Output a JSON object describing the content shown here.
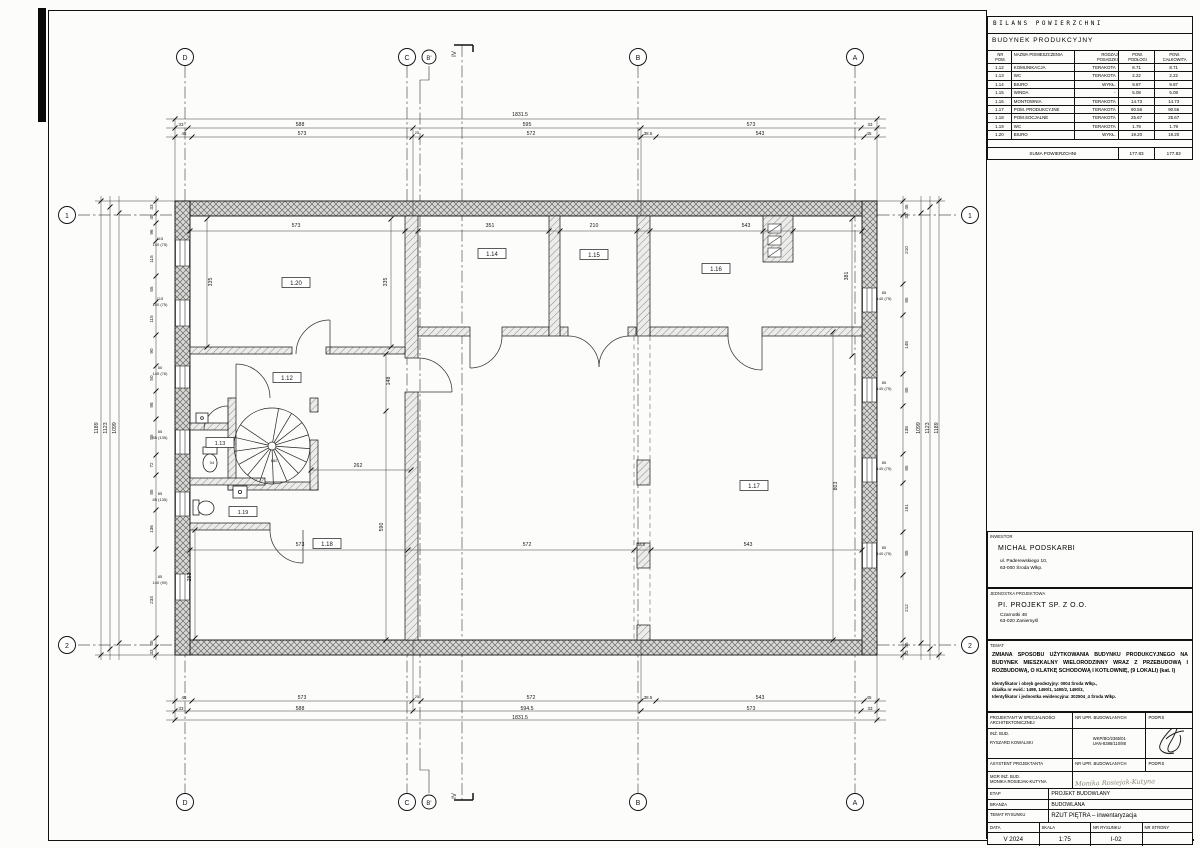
{
  "table": {
    "title": "BILANS POWIERZCHNI",
    "subtitle": "BUDYNEK PRODUKCYJNY",
    "headers": [
      "NR\nPOM.",
      "NAZWA POMIESZCZENIA",
      "RODZAJ\nPOSADZKI",
      "POW.\nPODŁOGI",
      "POW.\nCAŁKOWITA"
    ],
    "rows": [
      [
        "1.12",
        "KOMUNIKACJA",
        "TERAKOTA",
        "8.71",
        "8.71"
      ],
      [
        "1.13",
        "WC",
        "TERAKOTA",
        "2.22",
        "2.22"
      ],
      [
        "1.14",
        "BIURO",
        "WYKŁ. DYWANOWA",
        "9.87",
        "9.87"
      ],
      [
        "1.15",
        "WINDA",
        "-",
        "5.08",
        "5.08"
      ],
      [
        "1.16",
        "MONTOWNIA",
        "TERAKOTA",
        "14.73",
        "14.73"
      ],
      [
        "1.17",
        "POM. PRODUKCYJNE",
        "TERAKOTA",
        "90.56",
        "90.56"
      ],
      [
        "1.18",
        "POM.SOCJALNE",
        "TERAKOTA",
        "25.67",
        "25.67"
      ],
      [
        "1.19",
        "WC",
        "TERAKOTA",
        "1.79",
        "1.79"
      ],
      [
        "1.20",
        "BIURO",
        "WYKŁ. DYWANOWA",
        "19.20",
        "19.20"
      ]
    ],
    "sum_label": "SUMA POWIERZCHNI",
    "sum_floor": "177.83",
    "sum_total": "177.83"
  },
  "investor": {
    "label": "INWESTOR",
    "name": "MICHAŁ PODSKARBI",
    "addr1": "ul. Paderewskiego 10,",
    "addr2": "63-000 Środa Wlkp."
  },
  "unit": {
    "label": "JEDNOSTKA PROJEKTOWA",
    "name": "PI. PROJEKT SP. Z O.O.",
    "addr1": "Czarnotki 48",
    "addr2": "63-020 Zaniemyśl"
  },
  "temat": {
    "label": "TEMAT",
    "line1": "ZMIANA SPOSOBU UŻYTKOWANIA BUDYNKU PRODUKCYJNEGO NA BUDYNEK MIESZKALNY WIELORODZINNY WRAZ Z PRZEBUDOWĄ I ROZBUDOWĄ, O KLATKĘ SCHODOWĄ I KOTŁOWNIĘ, (9 LOKALI) (kat. I)",
    "geo1": "Identyfikator i obręb geodezyjny: 0004 Środa Wlkp.,",
    "geo2": "działka nr ewid.: 1498, 1490/1, 1490/2, 1490/3,",
    "geo3": "Identyfikator i jednostka ewidencyjna: 302504_4 Środa Wlkp."
  },
  "sig": {
    "r1a": "PROJEKTANT W SPECJALNOŚCI\nARCHITEKTONICZNEJ",
    "r1b": "NR UPR. BUDOWLANYCH",
    "r1c": "PODPIS",
    "r2a1": "INŻ. BUD.",
    "r2a2": "RYSZARD KOWALSKI",
    "r2b1": "WKP/BO/2365/01",
    "r2b2": "UAN-8386/110/88",
    "r3a": "ASYSTENT PROJEKTANTA",
    "r3b": "NR UPR. BUDOWLANYCH",
    "r3c": "PODPIS",
    "r4a1": "MGR INŻ. BUD.",
    "r4a2": "MONIKA ROSIEJAK-KUTYNA",
    "r4sig": "Monika  Rosiejak-Kutyna",
    "etap_l": "ETAP",
    "etap_v": "PROJEKT BUDOWLANY",
    "branza_l": "BRANŻA",
    "branza_v": "BUDOWLANA",
    "temat_rys_l": "TEMAT RYSUNKU",
    "temat_rys_v": "RZUT PIĘTRA – inwentaryzacja",
    "data_l": "DATA",
    "skala_l": "SKALA",
    "nr_rys_l": "NR RYSUNKU",
    "nr_str_l": "NR STRONY",
    "data_v": "V 2024",
    "skala_v": "1:75",
    "nr_rys_v": "I-02",
    "nr_str_v": ""
  },
  "plan": {
    "scale_note": "1:75",
    "labels": [
      {
        "x": 185,
        "y": 60,
        "t": "D",
        "fs": 7
      },
      {
        "x": 407,
        "y": 60,
        "t": "C",
        "fs": 7
      },
      {
        "x": 429,
        "y": 60,
        "t": "B'",
        "fs": 6
      },
      {
        "x": 638,
        "y": 60,
        "t": "B",
        "fs": 7
      },
      {
        "x": 855,
        "y": 60,
        "t": "A",
        "fs": 7
      },
      {
        "x": 185,
        "y": 805,
        "t": "D",
        "fs": 7
      },
      {
        "x": 407,
        "y": 805,
        "t": "C",
        "fs": 7
      },
      {
        "x": 429,
        "y": 805,
        "t": "B'",
        "fs": 6
      },
      {
        "x": 638,
        "y": 805,
        "t": "B",
        "fs": 7
      },
      {
        "x": 855,
        "y": 805,
        "t": "A",
        "fs": 7
      },
      {
        "x": 67,
        "y": 218,
        "t": "1",
        "fs": 7
      },
      {
        "x": 67,
        "y": 648,
        "t": "2",
        "fs": 7
      },
      {
        "x": 970,
        "y": 218,
        "t": "1",
        "fs": 7
      },
      {
        "x": 970,
        "y": 648,
        "t": "2",
        "fs": 7
      },
      {
        "x": 456,
        "y": 54,
        "t": "IV",
        "r": 1,
        "fs": 6
      },
      {
        "x": 456,
        "y": 796,
        "t": "IV",
        "r": 1,
        "fs": 6
      },
      {
        "x": 520,
        "y": 116,
        "t": "1831.5"
      },
      {
        "x": 181,
        "y": 126,
        "t": "33",
        "fs": 4.4
      },
      {
        "x": 300,
        "y": 126,
        "t": "588"
      },
      {
        "x": 527,
        "y": 126,
        "t": "595"
      },
      {
        "x": 751,
        "y": 126,
        "t": "573"
      },
      {
        "x": 870,
        "y": 126,
        "t": "33",
        "fs": 4.4
      },
      {
        "x": 184,
        "y": 135,
        "t": "45",
        "fs": 4.4
      },
      {
        "x": 302,
        "y": 135,
        "t": "573"
      },
      {
        "x": 417,
        "y": 134,
        "t": "25",
        "fs": 4
      },
      {
        "x": 531,
        "y": 135,
        "t": "572"
      },
      {
        "x": 648,
        "y": 135,
        "t": "38.5",
        "fs": 4.4
      },
      {
        "x": 760,
        "y": 135,
        "t": "543"
      },
      {
        "x": 869,
        "y": 135,
        "t": "45",
        "fs": 4.4
      },
      {
        "x": 184,
        "y": 699,
        "t": "45",
        "fs": 4.4
      },
      {
        "x": 302,
        "y": 699,
        "t": "573"
      },
      {
        "x": 417,
        "y": 698,
        "t": "25",
        "fs": 4
      },
      {
        "x": 531,
        "y": 699,
        "t": "572"
      },
      {
        "x": 648,
        "y": 699,
        "t": "38.5",
        "fs": 4.4
      },
      {
        "x": 760,
        "y": 699,
        "t": "543"
      },
      {
        "x": 869,
        "y": 699,
        "t": "45",
        "fs": 4.4
      },
      {
        "x": 181,
        "y": 710,
        "t": "33",
        "fs": 4.4
      },
      {
        "x": 300,
        "y": 710,
        "t": "588"
      },
      {
        "x": 527,
        "y": 710,
        "t": "594.5"
      },
      {
        "x": 751,
        "y": 710,
        "t": "573"
      },
      {
        "x": 870,
        "y": 710,
        "t": "33",
        "fs": 4.4
      },
      {
        "x": 520,
        "y": 719,
        "t": "1831.5"
      },
      {
        "x": 98,
        "y": 428,
        "t": "1189",
        "r": 1
      },
      {
        "x": 107,
        "y": 428,
        "t": "1123",
        "r": 1
      },
      {
        "x": 116,
        "y": 428,
        "t": "1099",
        "r": 1
      },
      {
        "x": 153,
        "y": 207,
        "t": "33",
        "r": 1,
        "fs": 4.6
      },
      {
        "x": 153,
        "y": 217,
        "t": "45",
        "r": 1,
        "fs": 4.6
      },
      {
        "x": 153,
        "y": 232,
        "t": "96",
        "r": 1,
        "fs": 4.6
      },
      {
        "x": 153,
        "y": 259,
        "t": "115",
        "r": 1,
        "fs": 4.6
      },
      {
        "x": 153,
        "y": 289,
        "t": "55",
        "r": 1,
        "fs": 4.6
      },
      {
        "x": 153,
        "y": 319,
        "t": "115",
        "r": 1,
        "fs": 4.6
      },
      {
        "x": 153,
        "y": 351,
        "t": "90",
        "r": 1,
        "fs": 4.6
      },
      {
        "x": 153,
        "y": 378,
        "t": "50",
        "r": 1,
        "fs": 4.6
      },
      {
        "x": 153,
        "y": 405,
        "t": "98",
        "r": 1,
        "fs": 4.6
      },
      {
        "x": 153,
        "y": 437,
        "t": "85",
        "r": 1,
        "fs": 4.6
      },
      {
        "x": 153,
        "y": 465,
        "t": "72",
        "r": 1,
        "fs": 4.6
      },
      {
        "x": 153,
        "y": 492,
        "t": "85",
        "r": 1,
        "fs": 4.6
      },
      {
        "x": 153,
        "y": 529,
        "t": "136",
        "r": 1,
        "fs": 4.6
      },
      {
        "x": 153,
        "y": 600,
        "t": "234",
        "r": 1,
        "fs": 4.6
      },
      {
        "x": 153,
        "y": 643,
        "t": "45",
        "r": 1,
        "fs": 4.6
      },
      {
        "x": 153,
        "y": 652,
        "t": "33",
        "r": 1,
        "fs": 4.6
      },
      {
        "x": 160,
        "y": 240,
        "t": "115",
        "fs": 4
      },
      {
        "x": 160,
        "y": 246,
        "t": "140 (75)",
        "fs": 4
      },
      {
        "x": 160,
        "y": 300,
        "t": "115",
        "fs": 4
      },
      {
        "x": 160,
        "y": 306,
        "t": "140 (75)",
        "fs": 4
      },
      {
        "x": 160,
        "y": 369,
        "t": "50",
        "fs": 4
      },
      {
        "x": 160,
        "y": 375,
        "t": "145 (76)",
        "fs": 4
      },
      {
        "x": 160,
        "y": 433,
        "t": "85",
        "fs": 4
      },
      {
        "x": 160,
        "y": 439,
        "t": "85 (135)",
        "fs": 4
      },
      {
        "x": 160,
        "y": 495,
        "t": "85",
        "fs": 4
      },
      {
        "x": 160,
        "y": 501,
        "t": "85 (135)",
        "fs": 4
      },
      {
        "x": 160,
        "y": 578,
        "t": "85",
        "fs": 4
      },
      {
        "x": 160,
        "y": 584,
        "t": "140 (90)",
        "fs": 4
      },
      {
        "x": 908,
        "y": 207,
        "t": "45",
        "r": 1,
        "fs": 4.6
      },
      {
        "x": 908,
        "y": 216,
        "t": "33",
        "r": 1,
        "fs": 4.6
      },
      {
        "x": 908,
        "y": 250,
        "t": "210",
        "r": 1,
        "fs": 4.6
      },
      {
        "x": 908,
        "y": 300,
        "t": "85",
        "r": 1,
        "fs": 4.6
      },
      {
        "x": 908,
        "y": 345,
        "t": "148",
        "r": 1,
        "fs": 4.6
      },
      {
        "x": 908,
        "y": 390,
        "t": "85",
        "r": 1,
        "fs": 4.6
      },
      {
        "x": 908,
        "y": 430,
        "t": "138",
        "r": 1,
        "fs": 4.6
      },
      {
        "x": 908,
        "y": 468,
        "t": "85",
        "r": 1,
        "fs": 4.6
      },
      {
        "x": 908,
        "y": 508,
        "t": "151",
        "r": 1,
        "fs": 4.6
      },
      {
        "x": 908,
        "y": 553,
        "t": "85",
        "r": 1,
        "fs": 4.6
      },
      {
        "x": 908,
        "y": 608,
        "t": "212",
        "r": 1,
        "fs": 4.6
      },
      {
        "x": 908,
        "y": 645,
        "t": "45",
        "r": 1,
        "fs": 4.6
      },
      {
        "x": 908,
        "y": 653,
        "t": "33",
        "r": 1,
        "fs": 4.6
      },
      {
        "x": 920,
        "y": 428,
        "t": "1099",
        "r": 1
      },
      {
        "x": 929,
        "y": 428,
        "t": "1123",
        "r": 1
      },
      {
        "x": 938,
        "y": 428,
        "t": "1189",
        "r": 1
      },
      {
        "x": 884,
        "y": 294,
        "t": "85",
        "fs": 4
      },
      {
        "x": 884,
        "y": 300,
        "t": "140 (75)",
        "fs": 4
      },
      {
        "x": 884,
        "y": 384,
        "t": "85",
        "fs": 4
      },
      {
        "x": 884,
        "y": 390,
        "t": "140 (75)",
        "fs": 4
      },
      {
        "x": 884,
        "y": 464,
        "t": "85",
        "fs": 4
      },
      {
        "x": 884,
        "y": 470,
        "t": "140 (75)",
        "fs": 4
      },
      {
        "x": 884,
        "y": 549,
        "t": "85",
        "fs": 4
      },
      {
        "x": 884,
        "y": 555,
        "t": "140 (75)",
        "fs": 4
      },
      {
        "x": 296,
        "y": 227,
        "t": "573"
      },
      {
        "x": 212,
        "y": 282,
        "t": "335",
        "r": 1
      },
      {
        "x": 387,
        "y": 282,
        "t": "335",
        "r": 1
      },
      {
        "x": 490,
        "y": 227,
        "t": "351"
      },
      {
        "x": 594,
        "y": 227,
        "t": "210"
      },
      {
        "x": 746,
        "y": 227,
        "t": "543"
      },
      {
        "x": 848,
        "y": 276,
        "t": "381",
        "r": 1
      },
      {
        "x": 390,
        "y": 381,
        "t": "148",
        "r": 1
      },
      {
        "x": 358,
        "y": 467,
        "t": "262"
      },
      {
        "x": 383,
        "y": 527,
        "t": "590",
        "r": 1
      },
      {
        "x": 300,
        "y": 546,
        "t": "573"
      },
      {
        "x": 527,
        "y": 546,
        "t": "572"
      },
      {
        "x": 748,
        "y": 546,
        "t": "543"
      },
      {
        "x": 641,
        "y": 546,
        "t": "38.5",
        "fs": 4
      },
      {
        "x": 837,
        "y": 486,
        "t": "803",
        "r": 1
      },
      {
        "x": 191,
        "y": 577,
        "t": "283",
        "r": 1
      },
      {
        "x": 274,
        "y": 462,
        "t": "182",
        "fs": 4
      },
      {
        "x": 212,
        "y": 464,
        "t": "04",
        "fs": 4
      },
      {
        "x": 296,
        "y": 285,
        "t": "1.20",
        "b": 1,
        "fs": 6
      },
      {
        "x": 287,
        "y": 380,
        "t": "1.12",
        "b": 1,
        "fs": 6
      },
      {
        "x": 492,
        "y": 256,
        "t": "1.14",
        "b": 1,
        "fs": 6
      },
      {
        "x": 594,
        "y": 257,
        "t": "1.15",
        "b": 1,
        "fs": 6
      },
      {
        "x": 716,
        "y": 271,
        "t": "1.16",
        "b": 1,
        "fs": 6
      },
      {
        "x": 754,
        "y": 488,
        "t": "1.17",
        "b": 1,
        "fs": 6
      },
      {
        "x": 327,
        "y": 546,
        "t": "1.18",
        "b": 1,
        "fs": 6
      },
      {
        "x": 220,
        "y": 445,
        "t": "1.13",
        "b": 1,
        "fs": 5.5
      },
      {
        "x": 243,
        "y": 514,
        "t": "1.19",
        "b": 1,
        "fs": 5.5
      }
    ]
  }
}
